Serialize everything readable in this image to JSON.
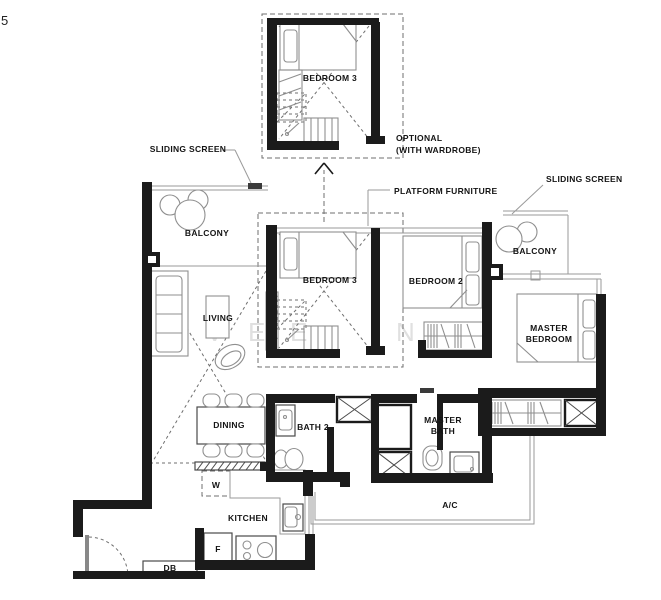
{
  "page": {
    "corner_number": "5"
  },
  "annotations": {
    "sliding_screen_left": "SLIDING SCREEN",
    "sliding_screen_right": "SLIDING SCREEN",
    "platform_furniture": "PLATFORM FURNITURE",
    "optional_line1": "OPTIONAL",
    "optional_line2": "(WITH WARDROBE)"
  },
  "rooms": {
    "bedroom3_optional": "BEDROOM 3",
    "bedroom3": "BEDROOM 3",
    "bedroom2": "BEDROOM 2",
    "master_bedroom_line1": "MASTER",
    "master_bedroom_line2": "BEDROOM",
    "living": "LIVING",
    "dining": "DINING",
    "balcony_left": "BALCONY",
    "balcony_right": "BALCONY",
    "bath2": "BATH 2",
    "master_bath_line1": "MASTER",
    "master_bath_line2": "BATH",
    "kitchen": "KITCHEN",
    "ac_ledge": "A/C"
  },
  "appliances": {
    "washer": "W",
    "fridge": "F",
    "db": "DB"
  },
  "watermark": {
    "letters": [
      "V",
      "E",
      "E",
      "N",
      "A",
      "N"
    ]
  },
  "colors": {
    "wall": "#1b1b1b",
    "furniture_line": "#8f8f8f",
    "dashed_line": "#6f6f6f",
    "text": "#141414",
    "watermark": "#e0e0e0",
    "background": "#ffffff"
  }
}
